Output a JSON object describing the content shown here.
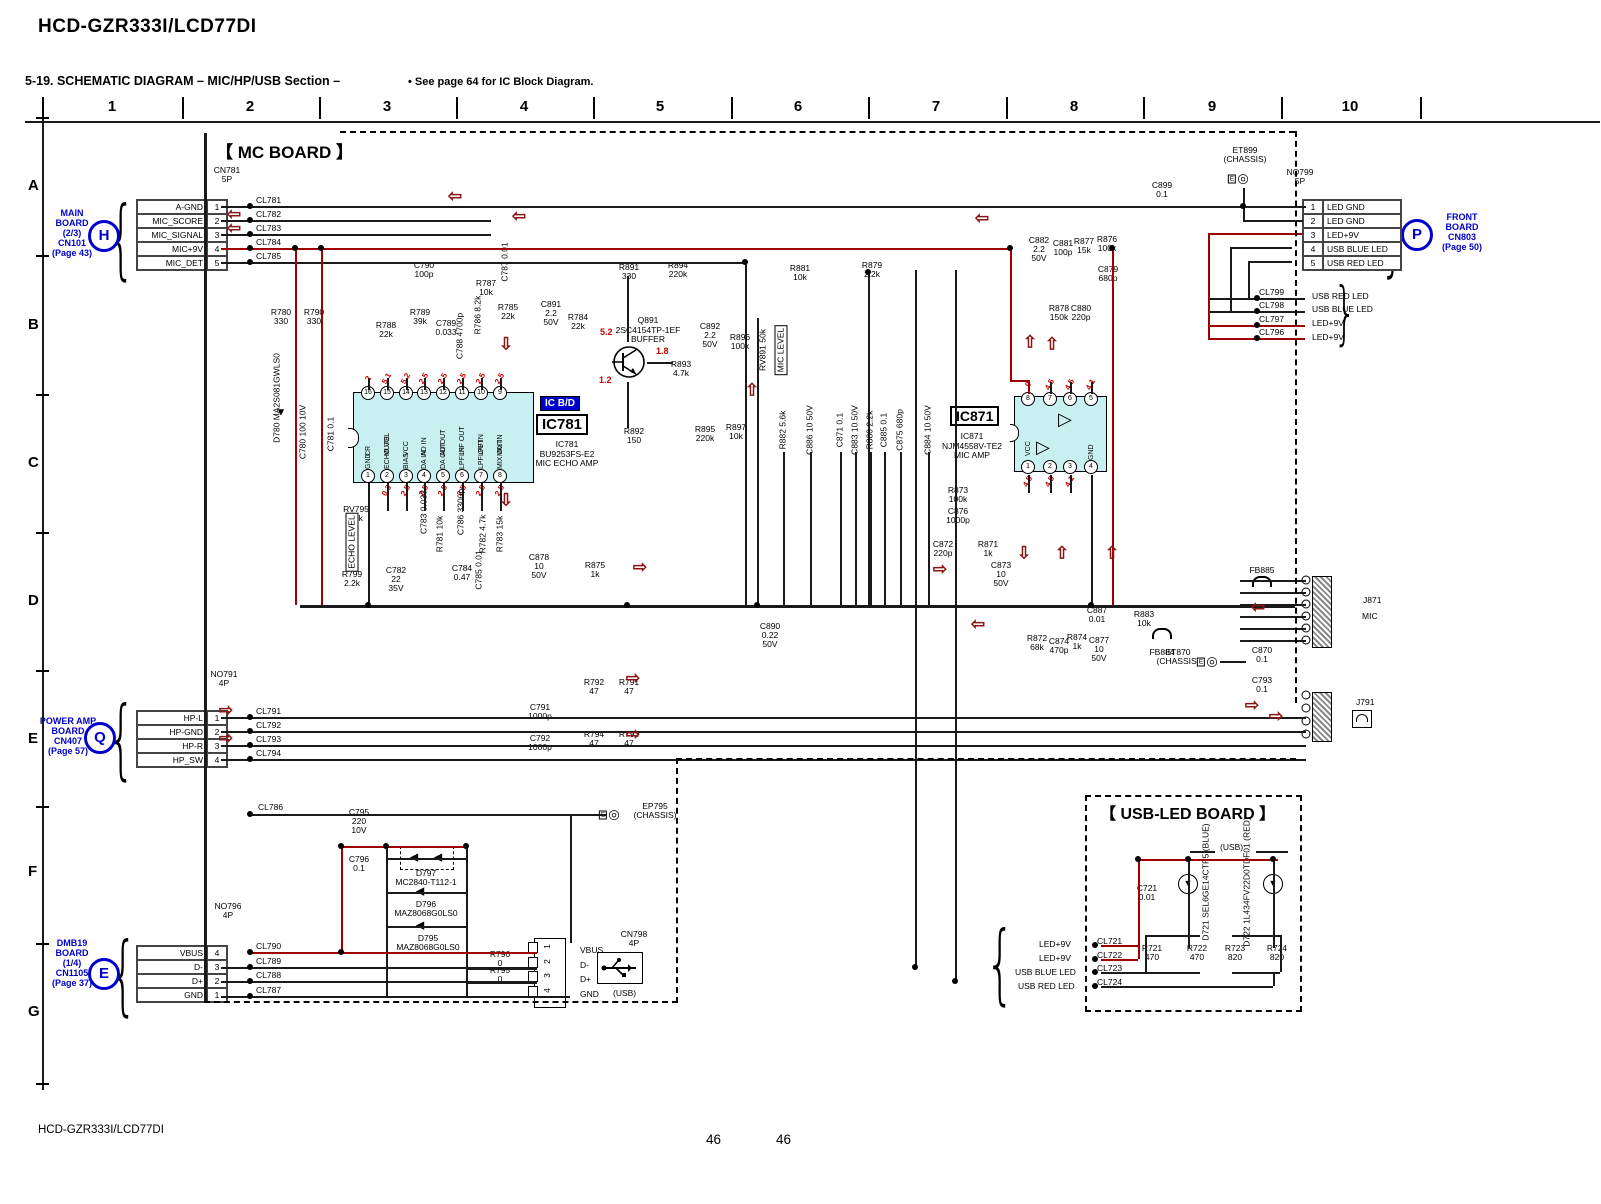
{
  "header": {
    "model": "HCD-GZR333I/LCD77DI",
    "section": "5-19.  SCHEMATIC  DIAGRAM  – MIC/HP/USB Section –",
    "note": "• See page 64 for IC Block Diagram."
  },
  "footer": {
    "model": "HCD-GZR333I/LCD77DI",
    "page_left": "46",
    "page_right": "46"
  },
  "grid": {
    "columns": [
      "1",
      "2",
      "3",
      "4",
      "5",
      "6",
      "7",
      "8",
      "9",
      "10"
    ],
    "rows": [
      "A",
      "B",
      "C",
      "D",
      "E",
      "F",
      "G"
    ]
  },
  "boards": {
    "mic": "【 MC BOARD 】",
    "usb_led": "【 USB-LED BOARD 】"
  },
  "connectors": {
    "main_board": {
      "circle": "H",
      "block": [
        "MAIN",
        "BOARD",
        "(2/3)",
        "CN101",
        "(Page 43)"
      ],
      "conn": [
        "CN781",
        "5P"
      ],
      "rows": [
        {
          "name": "A-GND",
          "pin": "1"
        },
        {
          "name": "MIC_SCORE",
          "pin": "2"
        },
        {
          "name": "MIC_SIGNAL",
          "pin": "3"
        },
        {
          "name": "MIC+9V",
          "pin": "4"
        },
        {
          "name": "MIC_DET",
          "pin": "5"
        }
      ]
    },
    "power_amp": {
      "circle": "Q",
      "block": [
        "POWER AMP",
        "BOARD",
        "CN407",
        "(Page 57)"
      ],
      "conn": [
        "NO791",
        "4P"
      ],
      "rows": [
        {
          "name": "HP-L",
          "pin": "1"
        },
        {
          "name": "HP-GND",
          "pin": "2"
        },
        {
          "name": "HP-R",
          "pin": "3"
        },
        {
          "name": "HP_SW",
          "pin": "4"
        }
      ]
    },
    "dmb19": {
      "circle": "E",
      "block": [
        "DMB19",
        "BOARD",
        "(1/4)",
        "CN1105",
        "(Page 37)"
      ],
      "conn": [
        "NO796",
        "4P"
      ],
      "rows": [
        {
          "name": "VBUS",
          "pin": "4"
        },
        {
          "name": "D-",
          "pin": "3"
        },
        {
          "name": "D+",
          "pin": "2"
        },
        {
          "name": "GND",
          "pin": "1"
        }
      ]
    },
    "front_board": {
      "circle": "P",
      "block": [
        "FRONT",
        "BOARD",
        "CN803",
        "(Page 50)"
      ],
      "conn": [
        "NO799",
        "5P"
      ],
      "rows": [
        {
          "pin": "1",
          "name": "LED GND"
        },
        {
          "pin": "2",
          "name": "LED GND"
        },
        {
          "pin": "3",
          "name": "LED+9V"
        },
        {
          "pin": "4",
          "name": "USB BLUE LED"
        },
        {
          "pin": "5",
          "name": "USB RED LED"
        }
      ]
    },
    "usb": {
      "conn": [
        "CN798",
        "4P"
      ],
      "label": "(USB)",
      "pins": [
        "1",
        "2",
        "3",
        "4"
      ],
      "names": [
        "VBUS",
        "D-",
        "D+",
        "GND"
      ]
    }
  },
  "ics": {
    "ic781": {
      "badge": "IC B/D",
      "big": "IC781",
      "lines": [
        "IC781",
        "BU9253FS-E2",
        "MIC ECHO AMP"
      ],
      "top": [
        {
          "n": "16",
          "name": "CR",
          "v": "2",
          "x": 368
        },
        {
          "n": "15",
          "name": "MUTE",
          "v": "5.1",
          "x": 387
        },
        {
          "n": "14",
          "name": "VCC",
          "v": "5.2",
          "x": 406
        },
        {
          "n": "13",
          "name": "AD IN",
          "v": "2.5",
          "x": 424
        },
        {
          "n": "12",
          "name": "AD OUT",
          "v": "2.5",
          "x": 443
        },
        {
          "n": "11",
          "name": "LPF OUT",
          "v": "2.5",
          "x": 462
        },
        {
          "n": "10",
          "name": "LPF IN",
          "v": "2.5",
          "x": 481
        },
        {
          "n": "9",
          "name": "MIX IN",
          "v": "2.5",
          "x": 500
        }
      ],
      "bottom": [
        {
          "n": "1",
          "name": "GND",
          "v": "",
          "x": 368
        },
        {
          "n": "2",
          "name": "ECHO VOL",
          "v": "0.3",
          "x": 387
        },
        {
          "n": "3",
          "name": "BIAS",
          "v": "2.5",
          "x": 406
        },
        {
          "n": "4",
          "name": "DA IN",
          "v": "2.5",
          "x": 424
        },
        {
          "n": "5",
          "name": "DA OUT",
          "v": "2.5",
          "x": 443
        },
        {
          "n": "6",
          "name": "LPF IN",
          "v": "2.5",
          "x": 462
        },
        {
          "n": "7",
          "name": "LPF OUT",
          "v": "2.5",
          "x": 481
        },
        {
          "n": "8",
          "name": "MIX OUT",
          "v": "2.5",
          "x": 500
        }
      ]
    },
    "ic871": {
      "big": "IC871",
      "lines": [
        "IC871",
        "NJM4558V-TE2",
        "MIC AMP"
      ],
      "top": [
        {
          "n": "8",
          "name": "VCC",
          "v": "9",
          "x": 1028
        },
        {
          "n": "7",
          "name": "",
          "v": "4.5",
          "x": 1050
        },
        {
          "n": "6",
          "name": "",
          "v": "4.5",
          "x": 1070
        },
        {
          "n": "5",
          "name": "",
          "v": "4.1",
          "x": 1091
        }
      ],
      "bottom": [
        {
          "n": "1",
          "name": "",
          "v": "4.5",
          "x": 1028
        },
        {
          "n": "2",
          "name": "",
          "v": "4.5",
          "x": 1050
        },
        {
          "n": "3",
          "name": "",
          "v": "4.1",
          "x": 1070
        },
        {
          "n": "4",
          "name": "GND",
          "v": "",
          "x": 1091
        }
      ]
    }
  },
  "transistor": {
    "lines": [
      "Q891",
      "2SC4154TP-1EF",
      "BUFFER"
    ],
    "v_top": "5.2",
    "v_mid": "1.8",
    "v_low": "1.2"
  },
  "jacks": {
    "mic": {
      "ref": "J871",
      "tag": "MIC"
    },
    "phones": {
      "ref": "J791"
    }
  },
  "chassis": [
    {
      "l": [
        "ET899",
        "(CHASSIS)"
      ],
      "x": 1245,
      "y": 146,
      "ix": 1243,
      "iy": 178
    },
    {
      "l": [
        "ET870",
        "(CHASSIS)"
      ],
      "x": 1178,
      "y": 648,
      "ix": 1212,
      "iy": 661
    },
    {
      "l": [
        "EP795",
        "(CHASSIS)"
      ],
      "x": 655,
      "y": 802,
      "ix": 614,
      "iy": 814
    }
  ],
  "components": [
    {
      "l": [
        "R780",
        "330"
      ],
      "x": 281,
      "y": 308
    },
    {
      "l": [
        "R790",
        "330"
      ],
      "x": 314,
      "y": 308
    },
    {
      "l": [
        "R788",
        "22k"
      ],
      "x": 386,
      "y": 321
    },
    {
      "l": [
        "C790",
        "100p"
      ],
      "x": 424,
      "y": 261
    },
    {
      "l": [
        "R789",
        "39k"
      ],
      "x": 420,
      "y": 308
    },
    {
      "l": [
        "C789",
        "0.033"
      ],
      "x": 446,
      "y": 319
    },
    {
      "l": [
        "R787",
        "10k"
      ],
      "x": 486,
      "y": 279
    },
    {
      "l": [
        "R785",
        "22k"
      ],
      "x": 508,
      "y": 303
    },
    {
      "l": [
        "C891",
        "2.2",
        "50V"
      ],
      "x": 551,
      "y": 300
    },
    {
      "l": [
        "R784",
        "22k"
      ],
      "x": 578,
      "y": 313
    },
    {
      "l": [
        "R891",
        "330"
      ],
      "x": 629,
      "y": 263
    },
    {
      "l": [
        "R894",
        "220k"
      ],
      "x": 678,
      "y": 261
    },
    {
      "l": [
        "C892",
        "2.2",
        "50V"
      ],
      "x": 710,
      "y": 322
    },
    {
      "l": [
        "R896",
        "100k"
      ],
      "x": 740,
      "y": 333
    },
    {
      "l": [
        "R893",
        "4.7k"
      ],
      "x": 681,
      "y": 360
    },
    {
      "l": [
        "R892",
        "150"
      ],
      "x": 634,
      "y": 427
    },
    {
      "l": [
        "R895",
        "220k"
      ],
      "x": 705,
      "y": 425
    },
    {
      "l": [
        "R897",
        "10k"
      ],
      "x": 736,
      "y": 423
    },
    {
      "l": [
        "R881",
        "10k"
      ],
      "x": 800,
      "y": 264
    },
    {
      "l": [
        "R879",
        "2.2k"
      ],
      "x": 872,
      "y": 261
    },
    {
      "l": [
        "C882",
        "2.2",
        "50V"
      ],
      "x": 1039,
      "y": 236
    },
    {
      "l": [
        "C881",
        "100p"
      ],
      "x": 1063,
      "y": 239
    },
    {
      "l": [
        "R877",
        "15k"
      ],
      "x": 1084,
      "y": 237
    },
    {
      "l": [
        "R876",
        "100k"
      ],
      "x": 1107,
      "y": 235
    },
    {
      "l": [
        "C879",
        "680p"
      ],
      "x": 1108,
      "y": 265
    },
    {
      "l": [
        "R878",
        "150k"
      ],
      "x": 1059,
      "y": 304
    },
    {
      "l": [
        "C880",
        "220p"
      ],
      "x": 1081,
      "y": 304
    },
    {
      "l": [
        "C899",
        "0.1"
      ],
      "x": 1162,
      "y": 181
    },
    {
      "l": [
        "R873",
        "100k"
      ],
      "x": 958,
      "y": 486
    },
    {
      "l": [
        "C876",
        "1000p"
      ],
      "x": 958,
      "y": 507
    },
    {
      "l": [
        "C872",
        "220p"
      ],
      "x": 943,
      "y": 540
    },
    {
      "l": [
        "R871",
        "1k"
      ],
      "x": 988,
      "y": 540
    },
    {
      "l": [
        "C873",
        "10",
        "50V"
      ],
      "x": 1001,
      "y": 561
    },
    {
      "l": [
        "R872",
        "68k"
      ],
      "x": 1037,
      "y": 634
    },
    {
      "l": [
        "C874",
        "470p"
      ],
      "x": 1059,
      "y": 637
    },
    {
      "l": [
        "R874",
        "1k"
      ],
      "x": 1077,
      "y": 633
    },
    {
      "l": [
        "C877",
        "10",
        "50V"
      ],
      "x": 1099,
      "y": 636
    },
    {
      "l": [
        "C887",
        "0.01"
      ],
      "x": 1097,
      "y": 606
    },
    {
      "l": [
        "R883",
        "10k"
      ],
      "x": 1144,
      "y": 610
    },
    {
      "l": [
        "FB884"
      ],
      "x": 1162,
      "y": 648
    },
    {
      "l": [
        "FB885"
      ],
      "x": 1262,
      "y": 566
    },
    {
      "l": [
        "C890",
        "0.22",
        "50V"
      ],
      "x": 770,
      "y": 622
    },
    {
      "l": [
        "RV795",
        "50k"
      ],
      "x": 356,
      "y": 505
    },
    {
      "l": [
        "R799",
        "2.2k"
      ],
      "x": 352,
      "y": 570
    },
    {
      "l": [
        "C782",
        "22",
        "35V"
      ],
      "x": 396,
      "y": 566
    },
    {
      "l": [
        "C784",
        "0.47"
      ],
      "x": 462,
      "y": 564
    },
    {
      "l": [
        "C878",
        "10",
        "50V"
      ],
      "x": 539,
      "y": 553
    },
    {
      "l": [
        "R875",
        "1k"
      ],
      "x": 595,
      "y": 561
    },
    {
      "l": [
        "R792",
        "47"
      ],
      "x": 594,
      "y": 678
    },
    {
      "l": [
        "R791",
        "47"
      ],
      "x": 629,
      "y": 678
    },
    {
      "l": [
        "C791",
        "1000p"
      ],
      "x": 540,
      "y": 703
    },
    {
      "l": [
        "C792",
        "1000p"
      ],
      "x": 540,
      "y": 734
    },
    {
      "l": [
        "R794",
        "47"
      ],
      "x": 594,
      "y": 730
    },
    {
      "l": [
        "R793",
        "47"
      ],
      "x": 629,
      "y": 730
    },
    {
      "l": [
        "C795",
        "220",
        "10V"
      ],
      "x": 359,
      "y": 808
    },
    {
      "l": [
        "C796",
        "0.1"
      ],
      "x": 359,
      "y": 855
    },
    {
      "l": [
        "D797",
        "MC2840-T112-1"
      ],
      "x": 426,
      "y": 869
    },
    {
      "l": [
        "D796",
        "MAZ8068G0LS0"
      ],
      "x": 426,
      "y": 900
    },
    {
      "l": [
        "D795",
        "MAZ8068G0LS0"
      ],
      "x": 428,
      "y": 934
    },
    {
      "l": [
        "R796",
        "0"
      ],
      "x": 500,
      "y": 950
    },
    {
      "l": [
        "R795",
        "0"
      ],
      "x": 500,
      "y": 966
    },
    {
      "l": [
        "C721",
        "0.01"
      ],
      "x": 1147,
      "y": 884
    },
    {
      "l": [
        "R721",
        "470"
      ],
      "x": 1152,
      "y": 944
    },
    {
      "l": [
        "R722",
        "470"
      ],
      "x": 1197,
      "y": 944
    },
    {
      "l": [
        "R723",
        "820"
      ],
      "x": 1235,
      "y": 944
    },
    {
      "l": [
        "R724",
        "820"
      ],
      "x": 1277,
      "y": 944
    },
    {
      "l": [
        "C870",
        "0.1"
      ],
      "x": 1262,
      "y": 646
    },
    {
      "l": [
        "C793",
        "0.1"
      ],
      "x": 1262,
      "y": 676
    },
    {
      "l": [
        "D780",
        "MA2S081GWLS0"
      ],
      "x": 277,
      "y": 398,
      "v": 1
    },
    {
      "l": [
        "C780  100  10V"
      ],
      "x": 303,
      "y": 432,
      "v": 1
    },
    {
      "l": [
        "C781  0.1"
      ],
      "x": 331,
      "y": 434,
      "v": 1
    },
    {
      "l": [
        "R786  8.2k"
      ],
      "x": 478,
      "y": 315,
      "v": 1
    },
    {
      "l": [
        "C788  4700p"
      ],
      "x": 460,
      "y": 336,
      "v": 1
    },
    {
      "l": [
        "C787  0.01"
      ],
      "x": 505,
      "y": 262,
      "v": 1
    },
    {
      "l": [
        "RV891  50k"
      ],
      "x": 763,
      "y": 350,
      "v": 1
    },
    {
      "l": [
        "MIC LEVEL"
      ],
      "x": 781,
      "y": 350,
      "v": 1,
      "c": "b"
    },
    {
      "l": [
        "R882  5.6k"
      ],
      "x": 783,
      "y": 430,
      "v": 1
    },
    {
      "l": [
        "C886  10  50V"
      ],
      "x": 810,
      "y": 430,
      "v": 1
    },
    {
      "l": [
        "C871  0.1"
      ],
      "x": 840,
      "y": 430,
      "v": 1
    },
    {
      "l": [
        "C883  10  50V"
      ],
      "x": 855,
      "y": 430,
      "v": 1
    },
    {
      "l": [
        "R880  2.2k"
      ],
      "x": 870,
      "y": 430,
      "v": 1
    },
    {
      "l": [
        "C885  0.1"
      ],
      "x": 884,
      "y": 430,
      "v": 1
    },
    {
      "l": [
        "C875  680p"
      ],
      "x": 900,
      "y": 430,
      "v": 1
    },
    {
      "l": [
        "C884  10  50V"
      ],
      "x": 928,
      "y": 430,
      "v": 1
    },
    {
      "l": [
        "C783  0.033"
      ],
      "x": 424,
      "y": 512,
      "v": 1
    },
    {
      "l": [
        "R781  10k"
      ],
      "x": 440,
      "y": 534,
      "v": 1
    },
    {
      "l": [
        "C786  3300p"
      ],
      "x": 461,
      "y": 512,
      "v": 1
    },
    {
      "l": [
        "R782  4.7k"
      ],
      "x": 483,
      "y": 534,
      "v": 1
    },
    {
      "l": [
        "R783  15k"
      ],
      "x": 500,
      "y": 534,
      "v": 1
    },
    {
      "l": [
        "C785  0.01"
      ],
      "x": 479,
      "y": 570,
      "v": 1
    },
    {
      "l": [
        "ECHO LEVEL"
      ],
      "x": 352,
      "y": 542,
      "v": 1,
      "c": "b"
    },
    {
      "l": [
        "D721",
        "SEL6GE14CTP5",
        "(BLUE)"
      ],
      "x": 1206,
      "y": 882,
      "v": 1
    },
    {
      "l": [
        "D722",
        "1L434FV22D0TDF01",
        "(RED)"
      ],
      "x": 1247,
      "y": 882,
      "v": 1
    }
  ],
  "labels": [
    {
      "t": "CL781",
      "x": 256,
      "y": 196
    },
    {
      "t": "CL782",
      "x": 256,
      "y": 210
    },
    {
      "t": "CL783",
      "x": 256,
      "y": 224
    },
    {
      "t": "CL784",
      "x": 256,
      "y": 238
    },
    {
      "t": "CL785",
      "x": 256,
      "y": 252
    },
    {
      "t": "CL791",
      "x": 256,
      "y": 707
    },
    {
      "t": "CL792",
      "x": 256,
      "y": 721
    },
    {
      "t": "CL793",
      "x": 256,
      "y": 735
    },
    {
      "t": "CL794",
      "x": 256,
      "y": 749
    },
    {
      "t": "CL786",
      "x": 258,
      "y": 803
    },
    {
      "t": "CL790",
      "x": 256,
      "y": 942
    },
    {
      "t": "CL789",
      "x": 256,
      "y": 957
    },
    {
      "t": "CL788",
      "x": 256,
      "y": 971
    },
    {
      "t": "CL787",
      "x": 256,
      "y": 986
    },
    {
      "t": "CL799",
      "x": 1259,
      "y": 288
    },
    {
      "t": "USB RED LED",
      "x": 1312,
      "y": 292
    },
    {
      "t": "CL798",
      "x": 1259,
      "y": 301
    },
    {
      "t": "USB BLUE LED",
      "x": 1312,
      "y": 305
    },
    {
      "t": "CL797",
      "x": 1259,
      "y": 315
    },
    {
      "t": "LED+9V",
      "x": 1312,
      "y": 319
    },
    {
      "t": "CL796",
      "x": 1259,
      "y": 328
    },
    {
      "t": "LED+9V",
      "x": 1312,
      "y": 333
    },
    {
      "t": "LED+9V",
      "x": 1039,
      "y": 940
    },
    {
      "t": "CL721",
      "x": 1097,
      "y": 937
    },
    {
      "t": "LED+9V",
      "x": 1039,
      "y": 954
    },
    {
      "t": "CL722",
      "x": 1097,
      "y": 951
    },
    {
      "t": "USB BLUE LED",
      "x": 1015,
      "y": 968
    },
    {
      "t": "CL723",
      "x": 1097,
      "y": 964
    },
    {
      "t": "USB RED LED",
      "x": 1018,
      "y": 982
    },
    {
      "t": "CL724",
      "x": 1097,
      "y": 978
    },
    {
      "t": "(USB)",
      "x": 1220,
      "y": 843
    },
    {
      "t": "(USB)",
      "x": 613,
      "y": 989
    },
    {
      "t": "VBUS",
      "x": 580,
      "y": 946
    },
    {
      "t": "D-",
      "x": 580,
      "y": 961
    },
    {
      "t": "D+",
      "x": 580,
      "y": 975
    },
    {
      "t": "GND",
      "x": 580,
      "y": 990
    },
    {
      "t": "J871",
      "x": 1363,
      "y": 596
    },
    {
      "t": "MIC",
      "x": 1362,
      "y": 612,
      "c": "b"
    },
    {
      "t": "J791",
      "x": 1356,
      "y": 698
    },
    {
      "t": "5.2",
      "x": 600,
      "y": 328,
      "c": "volt"
    },
    {
      "t": "1.8",
      "x": 656,
      "y": 347,
      "c": "volt"
    },
    {
      "t": "1.2",
      "x": 599,
      "y": 376,
      "c": "volt"
    }
  ]
}
